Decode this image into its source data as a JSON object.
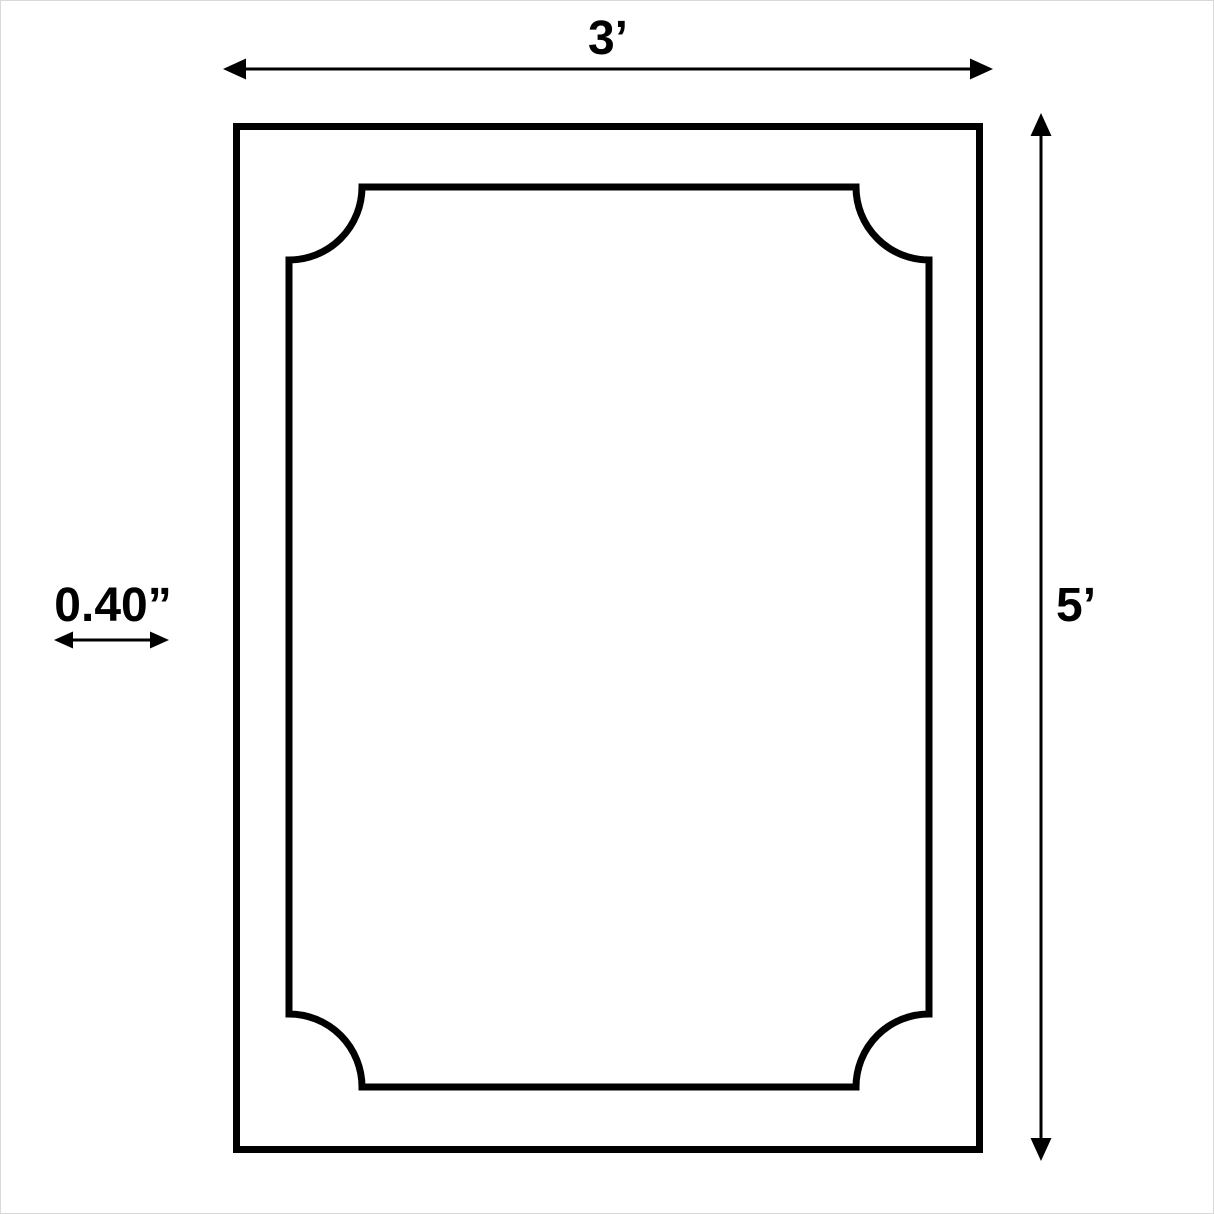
{
  "diagram": {
    "width_label": "3’",
    "height_label": "5’",
    "thickness_label": "0.40”",
    "colors": {
      "line": "#000000",
      "background": "#ffffff"
    }
  }
}
